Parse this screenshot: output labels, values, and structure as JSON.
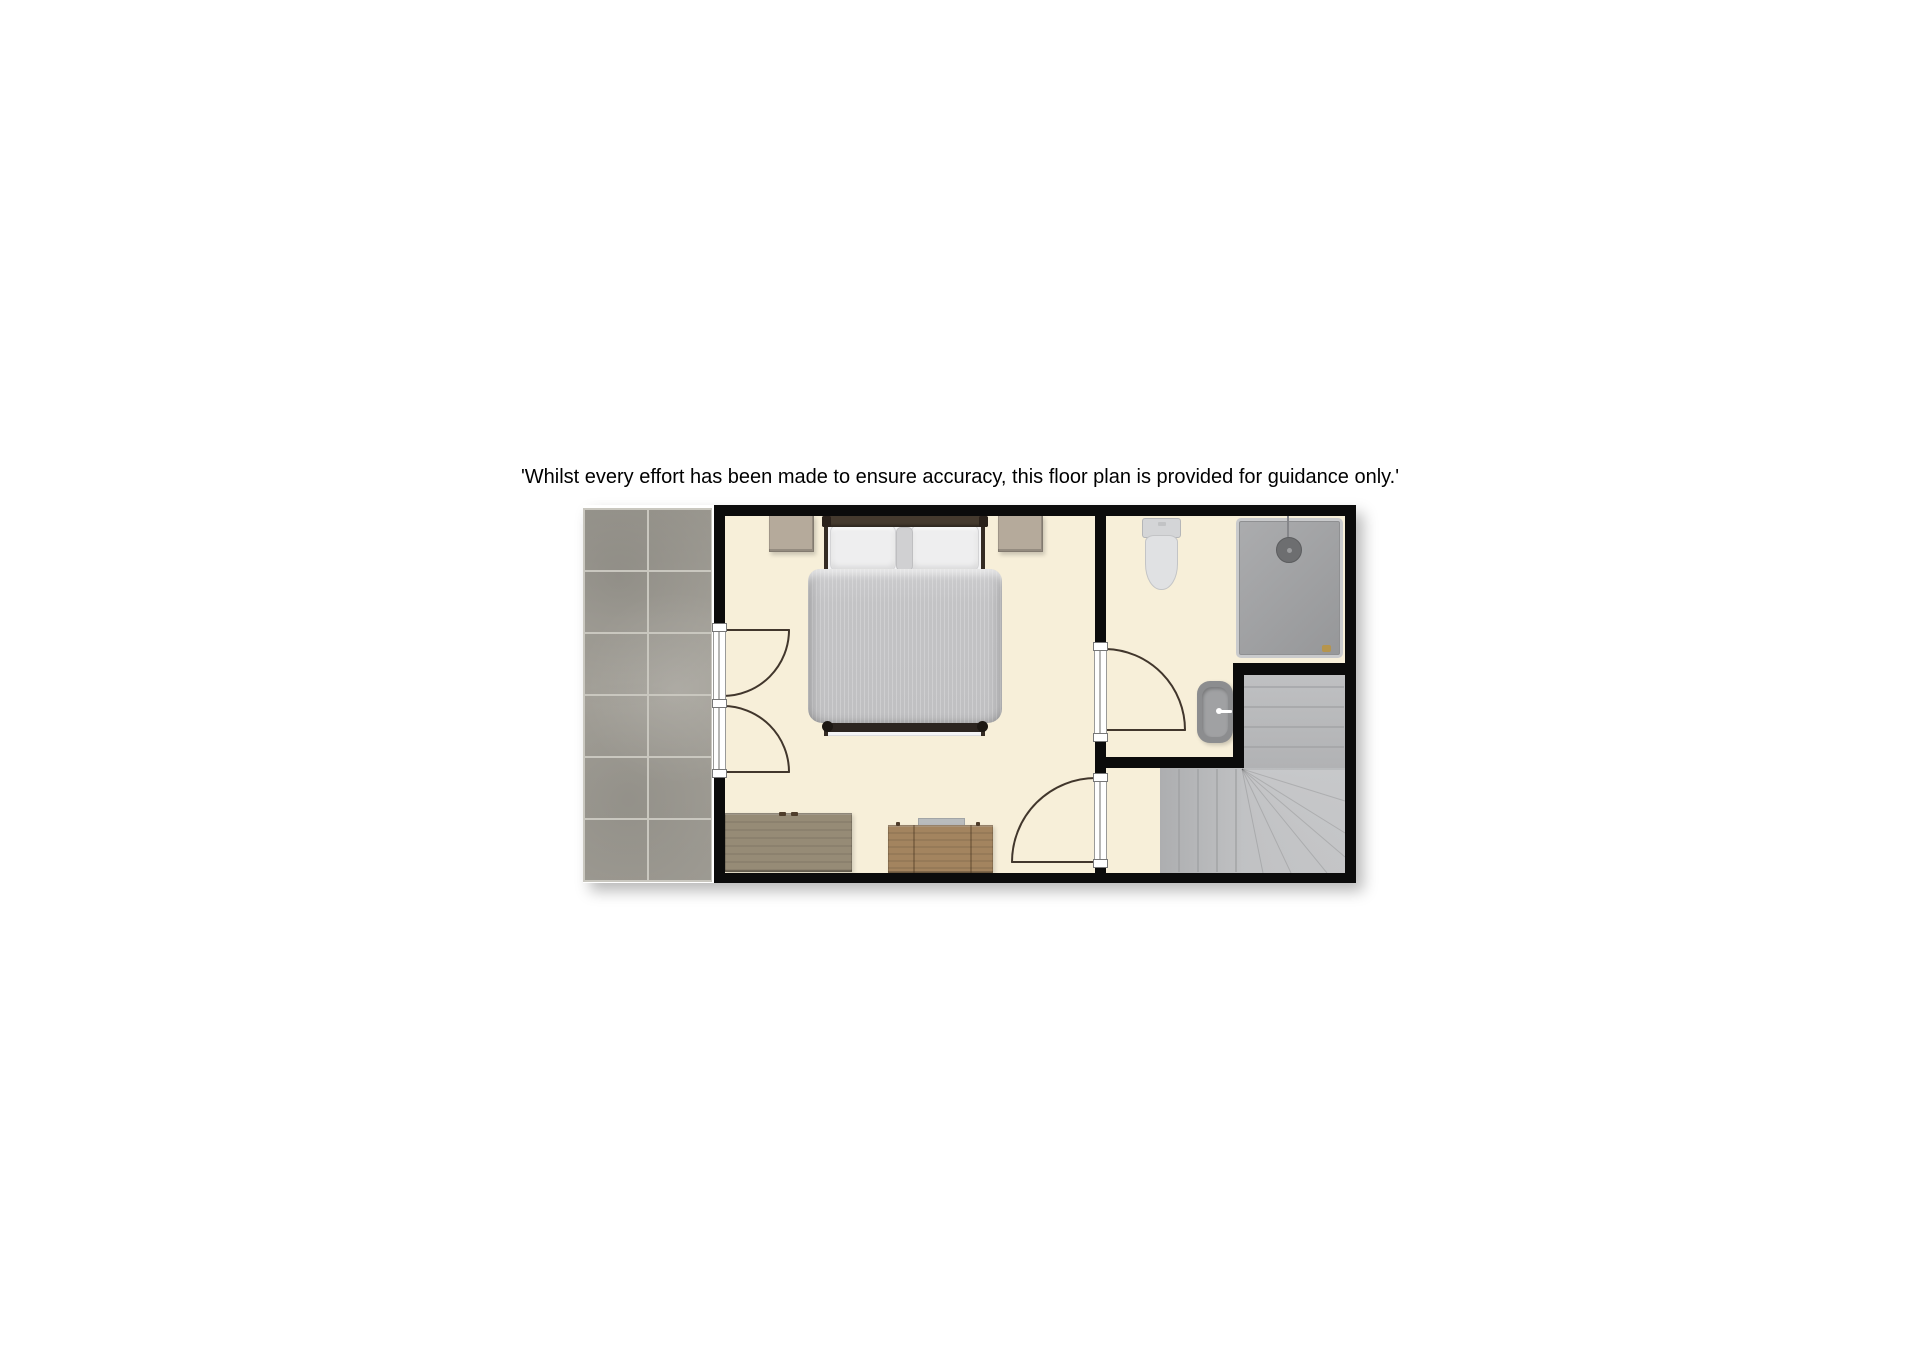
{
  "disclaimer": "'Whilst every effort has been made to ensure accuracy, this floor plan is provided for guidance only.'",
  "plan": {
    "rooms": [
      "bedroom",
      "bathroom",
      "stair-landing",
      "tiled-terrace"
    ],
    "furniture": [
      "double-bed",
      "nightstand-left",
      "nightstand-right",
      "chest-of-drawers-large",
      "chest-of-drawers-small"
    ],
    "fixtures": [
      "toilet",
      "wash-basin",
      "shower-enclosure",
      "winder-staircase"
    ],
    "doors": [
      "french-doors-to-terrace",
      "bathroom-door",
      "bedroom-door-to-landing"
    ]
  },
  "colors": {
    "wall": "#0b0b0b",
    "floor": "#f7efd9",
    "tile_base": "#a5a29a",
    "tile_grout": "#c9c7bf",
    "stair": "#bcbdbf",
    "stair_line": "#9fa0a2",
    "duvet": "#c5c5c7",
    "pillow": "#eeeeef",
    "headboard": "#453a2e",
    "bed_frame": "#342b23",
    "nightstand": "#b5aa9b",
    "dresser_a": "#968b76",
    "dresser_b": "#a3845f",
    "ceramic": "#d9dadc",
    "basin": "#8c8d8f",
    "shower_tray": "#a1a2a4",
    "door_arc": "#41362c",
    "drain": "#b6954d"
  }
}
